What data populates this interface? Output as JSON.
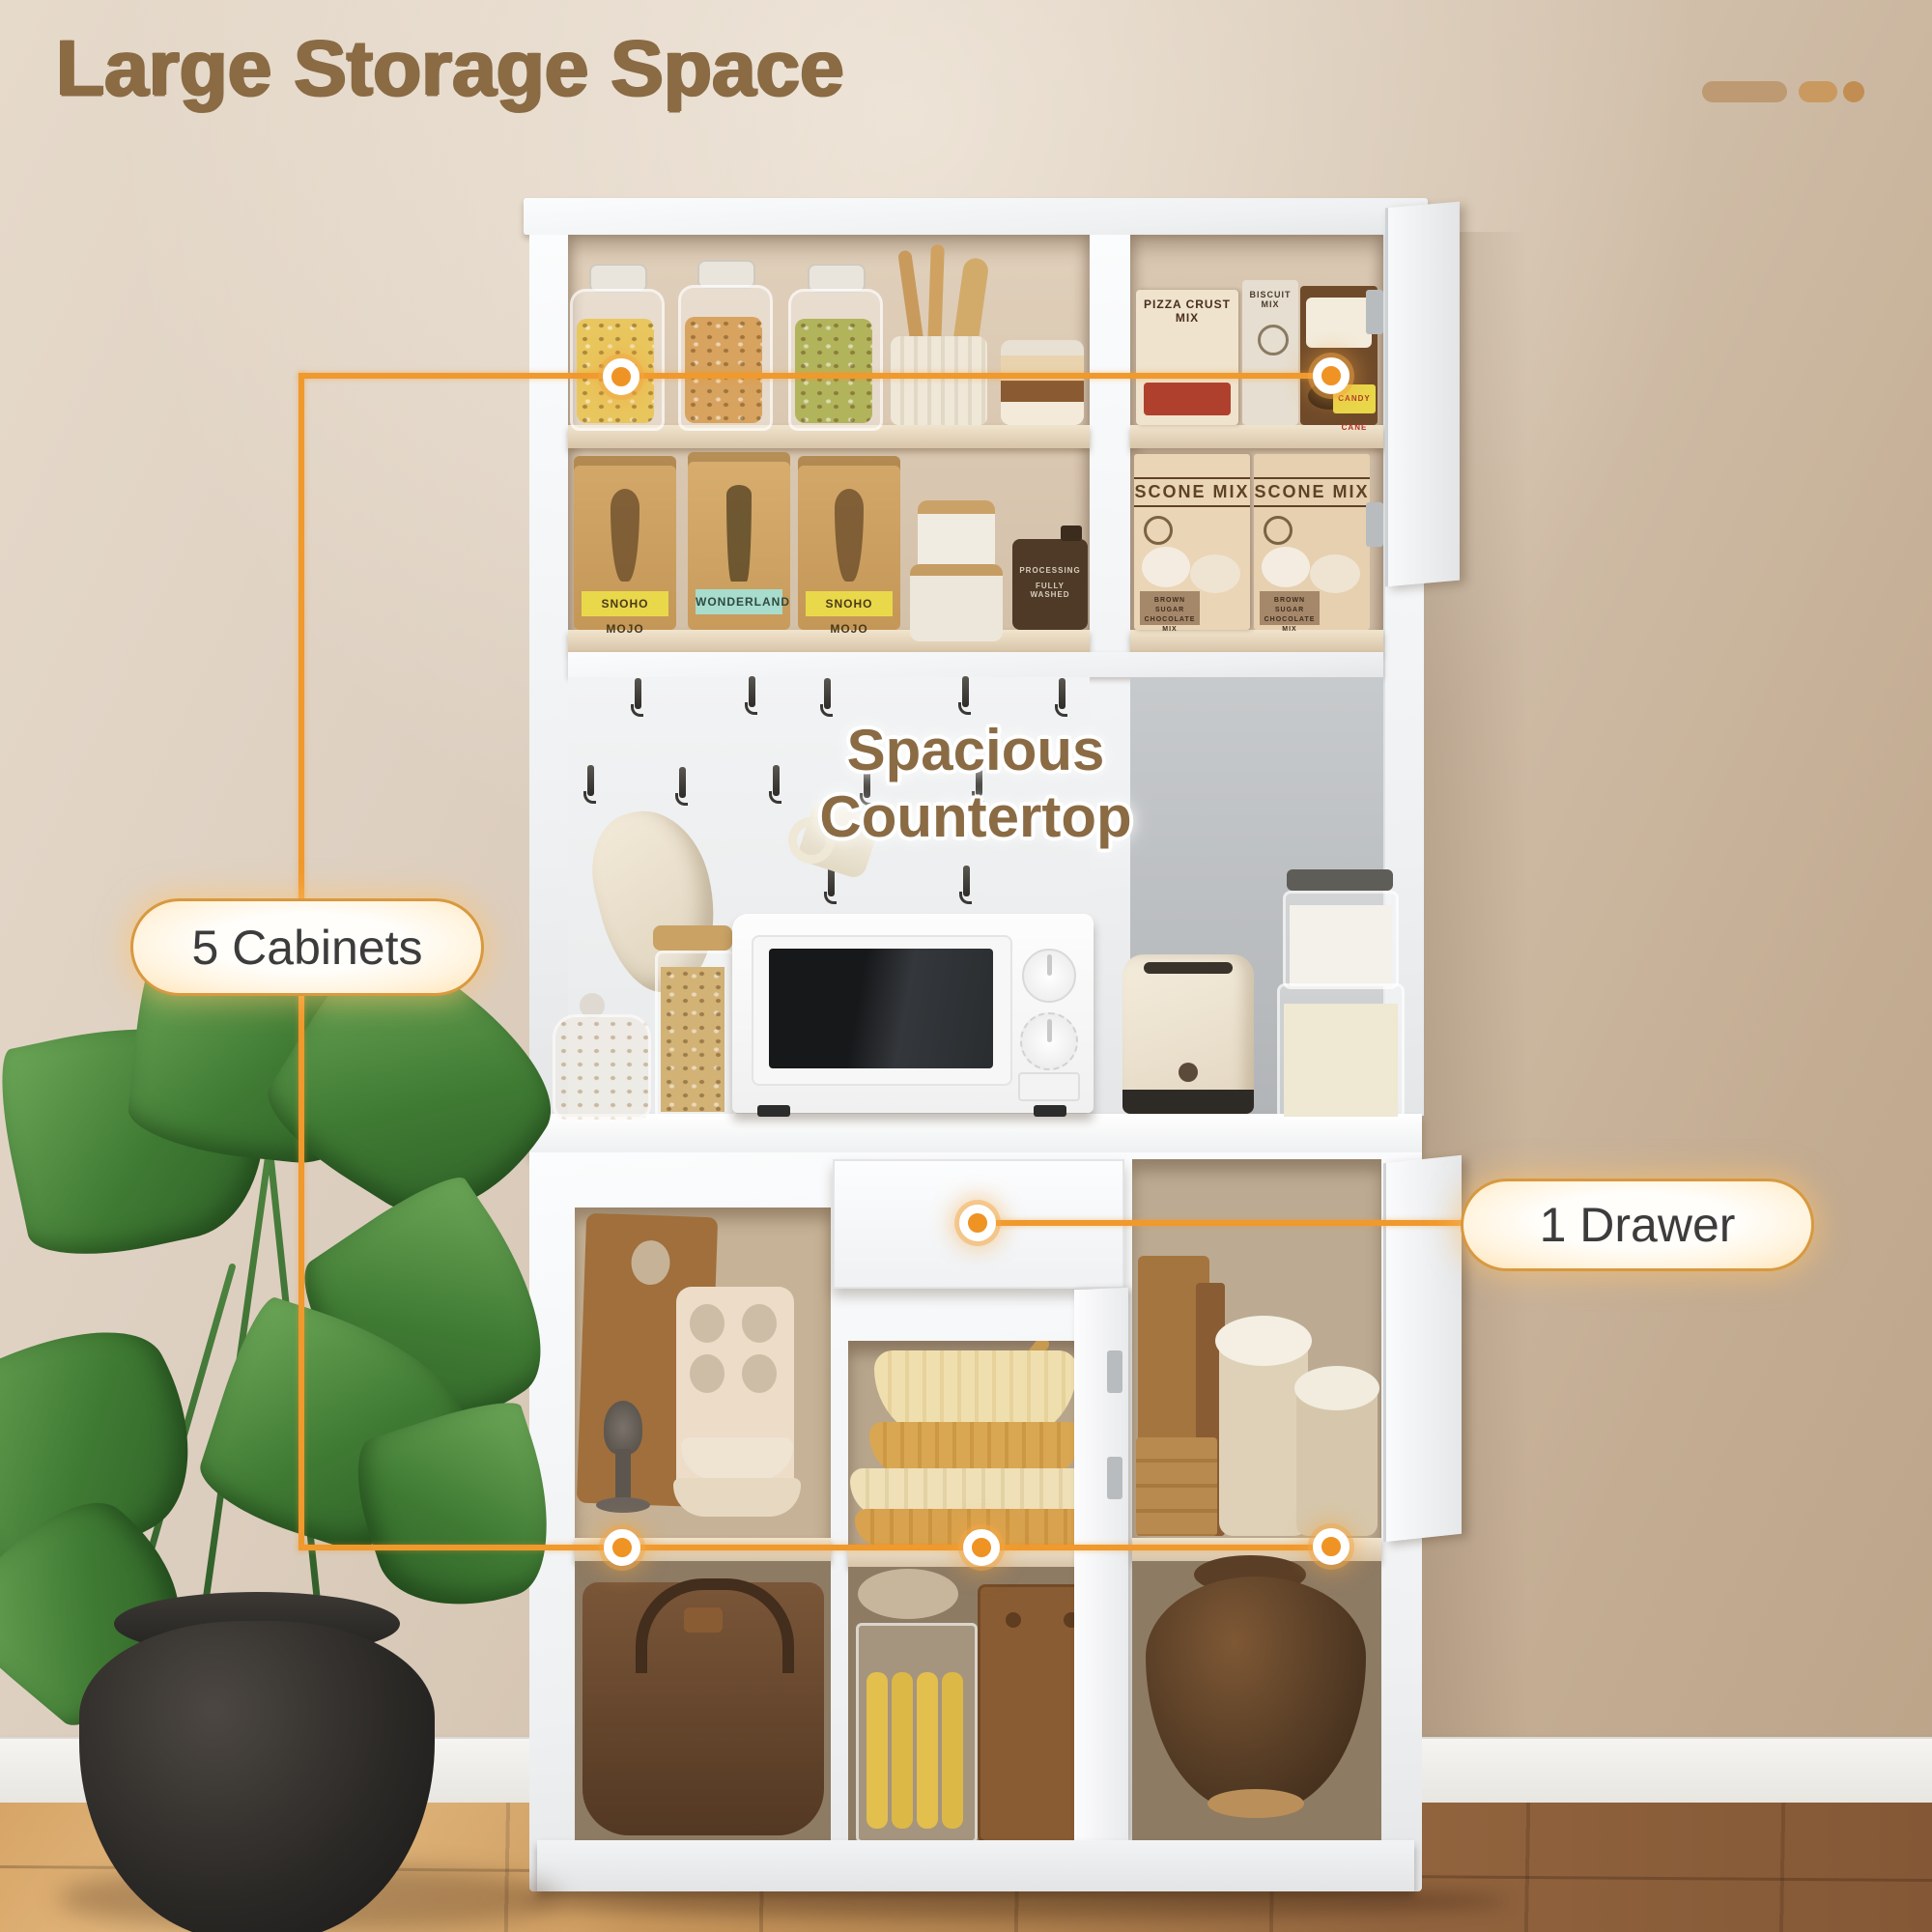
{
  "page": {
    "title": "Large Storage Space"
  },
  "callouts": {
    "countertop_label": "Spacious Countertop",
    "cabinets_pill": "5 Cabinets",
    "drawer_pill": "1 Drawer"
  },
  "pantry_items": {
    "coffee_bags": [
      {
        "label": "SNOHO MOJO"
      },
      {
        "label": "WONDERLAND"
      },
      {
        "label": "SNOHO MOJO"
      }
    ],
    "mix_boxes_top": [
      {
        "label": "PIZZA CRUST MIX"
      },
      {
        "label": "BISCUIT MIX"
      },
      {
        "label": "CANDY CANE"
      }
    ],
    "scone_boxes": [
      {
        "title": "SCONE MIX",
        "subtitle": "BROWN SUGAR CHOCOLATE MIX"
      },
      {
        "title": "SCONE MIX",
        "subtitle": "BROWN SUGAR CHOCOLATE MIX"
      }
    ],
    "flask_lines": [
      "PROCESSING",
      "FULLY WASHED"
    ]
  },
  "colors": {
    "accent_orange": "#F0992C",
    "title_brown": "#8A6B44",
    "pill_border": "#D8993F",
    "pill_text": "#3C3C3C",
    "wall_beige": "#D8CABB",
    "floor_wood_left": "#CF9A5D",
    "floor_wood_right": "#8E613C"
  }
}
